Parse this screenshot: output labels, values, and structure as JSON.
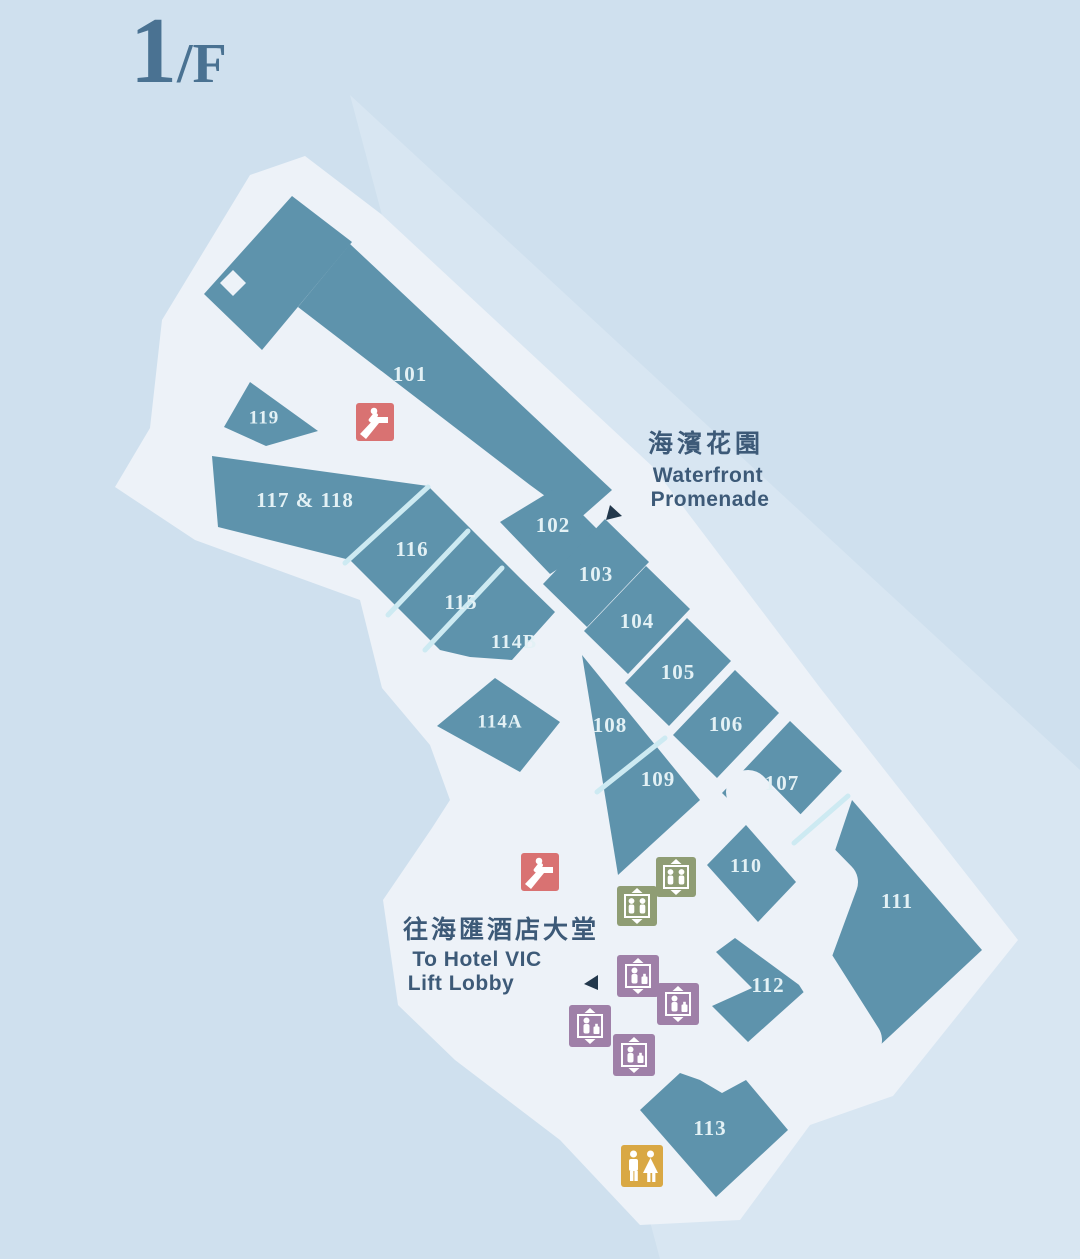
{
  "title": {
    "number": "1",
    "suffix": "/F"
  },
  "shops": [
    {
      "unit": "101"
    },
    {
      "unit": "102"
    },
    {
      "unit": "103"
    },
    {
      "unit": "104"
    },
    {
      "unit": "105"
    },
    {
      "unit": "106"
    },
    {
      "unit": "107"
    },
    {
      "unit": "108"
    },
    {
      "unit": "109"
    },
    {
      "unit": "110"
    },
    {
      "unit": "111"
    },
    {
      "unit": "112"
    },
    {
      "unit": "113"
    },
    {
      "unit": "114A"
    },
    {
      "unit": "114B"
    },
    {
      "unit": "115"
    },
    {
      "unit": "116"
    },
    {
      "unit": "117 & 118"
    },
    {
      "unit": "119"
    }
  ],
  "annotations": {
    "waterfront": {
      "zh": "海濱花園",
      "en1": "Waterfront",
      "en2": "Promenade"
    },
    "hotel": {
      "zh": "往海匯酒店大堂",
      "en1": "To Hotel VIC",
      "en2": "Lift Lobby"
    }
  },
  "facilities": {
    "escalator_count": 2,
    "mall_lift_count": 2,
    "hotel_lift_count": 4,
    "toilet_count": 1
  },
  "colors": {
    "background": "#cfe0ee",
    "promenade_tint": "#d8e6f2",
    "walkway": "#edf2f8",
    "shop_fill": "#5e93ac",
    "shop_label": "#e3f1f5",
    "divider": "#cdeaf2",
    "text_dark": "#3d5a78",
    "title": "#4a7292",
    "escalator_icon": "#d97272",
    "lift_icon": "#8f9d74",
    "hotel_lift_icon": "#9f80a8",
    "toilet_icon": "#d9a844",
    "arrow": "#22384c",
    "icon_glyph": "#ffffff"
  }
}
